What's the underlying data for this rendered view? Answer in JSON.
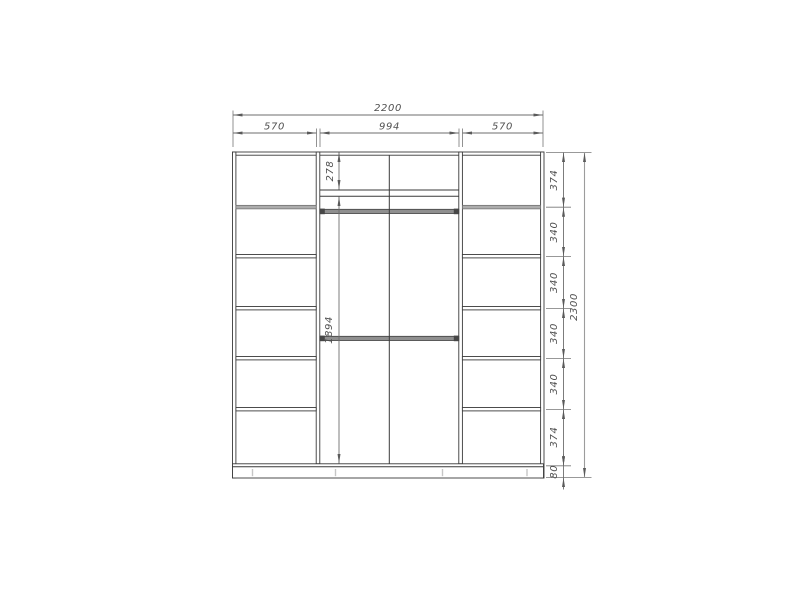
{
  "drawing": {
    "dimensions": {
      "overall_width_mm": "2200",
      "top_widths": [
        "570",
        "994",
        "570"
      ],
      "left_heights": [
        "278",
        "1894"
      ],
      "right_heights": [
        "374",
        "340",
        "340",
        "340",
        "340",
        "374",
        "80"
      ],
      "overall_height_mm": "2300"
    },
    "colors": {
      "object_line": "#3a3a3a",
      "dimension_line": "#6e6e6e",
      "overall_dimension_line": "#9c9c9c",
      "dimension_text": "#4f4f4f",
      "shelf_gray": "#adadad",
      "rail_gray": "#8f8f8f",
      "background": "#ffffff"
    }
  }
}
